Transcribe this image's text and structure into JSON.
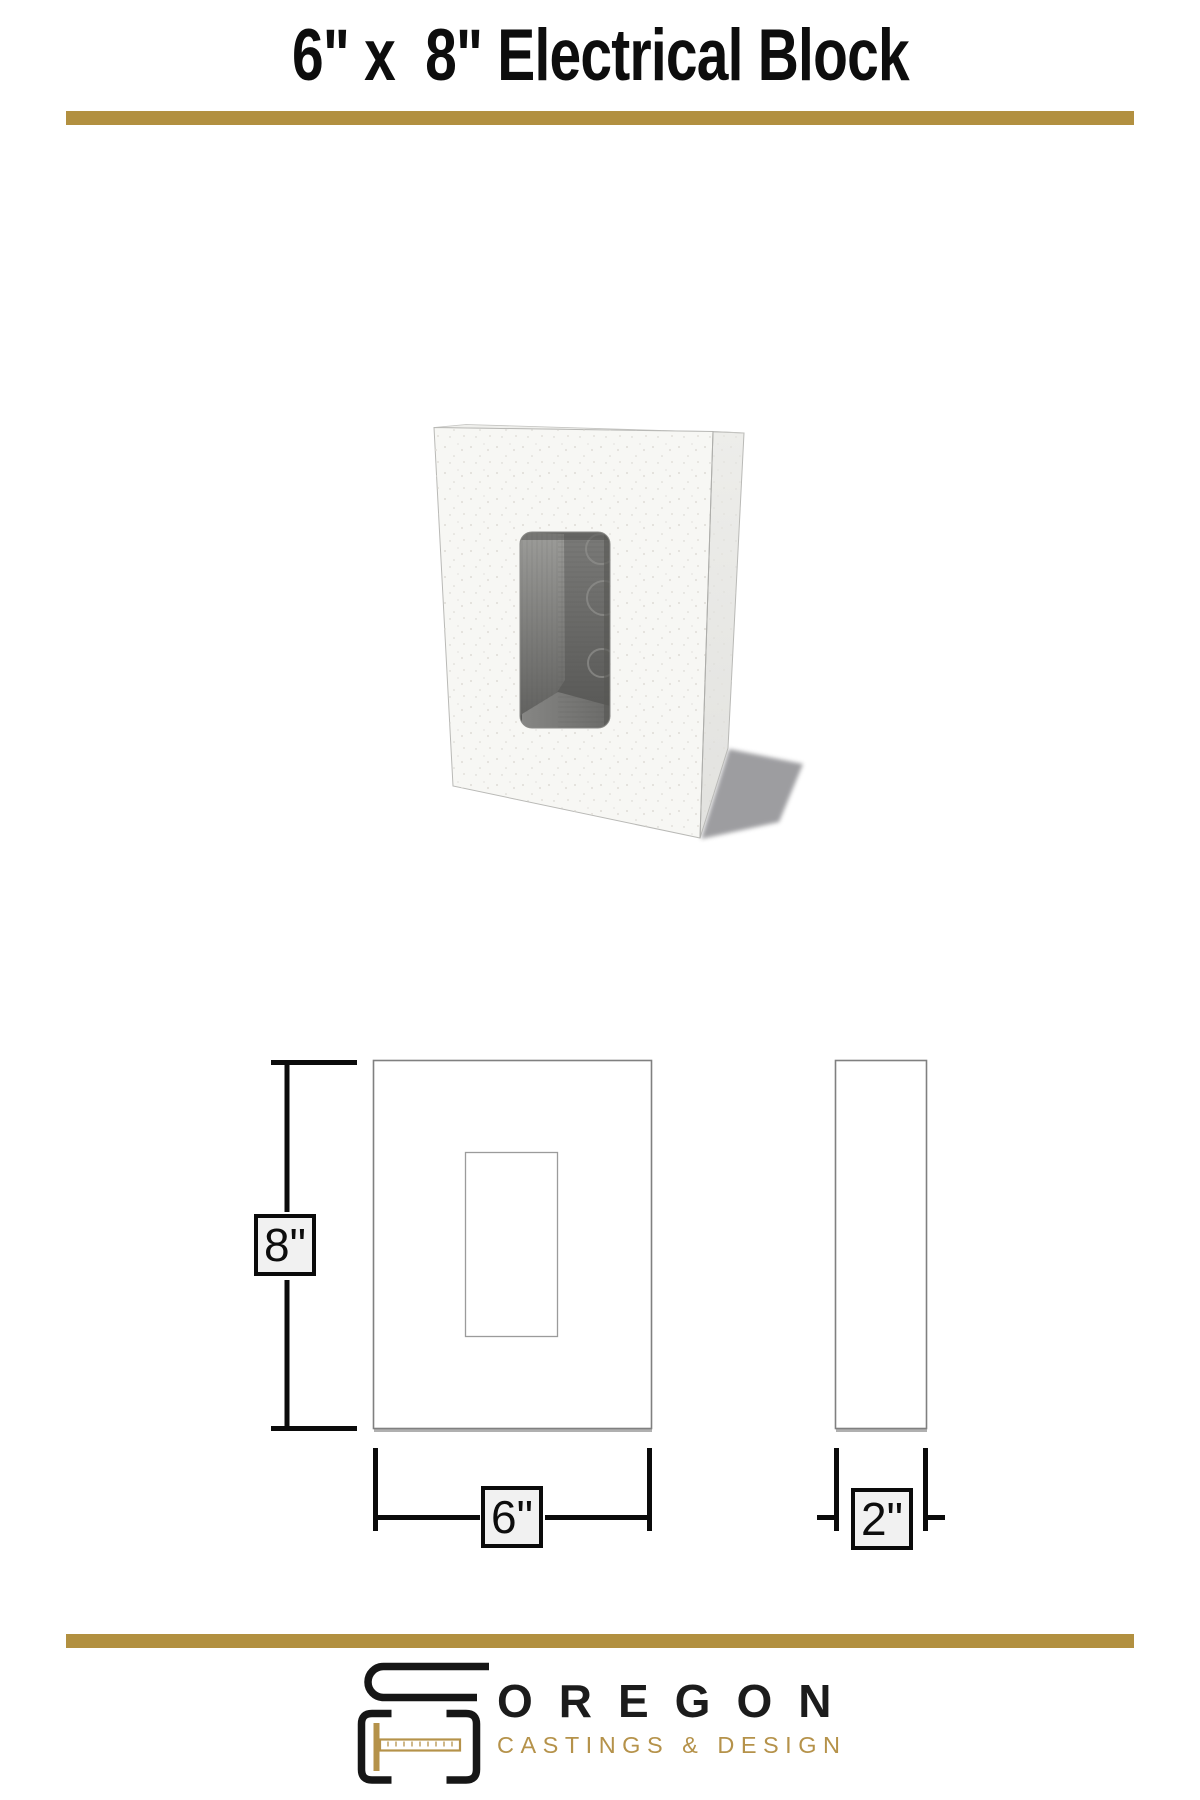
{
  "header": {
    "title": "6\" x  8\" Electrical Block"
  },
  "theme": {
    "divider_gold": "#B29040",
    "logo_gold": "#B5924A",
    "ink": "#0B0B0B",
    "drawing_line_gray": "#808080",
    "label_box_fill": "#F1F1F1"
  },
  "drawing": {
    "front_view": {
      "height_label": "8\"",
      "width_label": "6\""
    },
    "side_view": {
      "thickness_label": "2\""
    }
  },
  "footer": {
    "brand_name": "OREGON",
    "brand_tagline": "CASTINGS & DESIGN"
  }
}
